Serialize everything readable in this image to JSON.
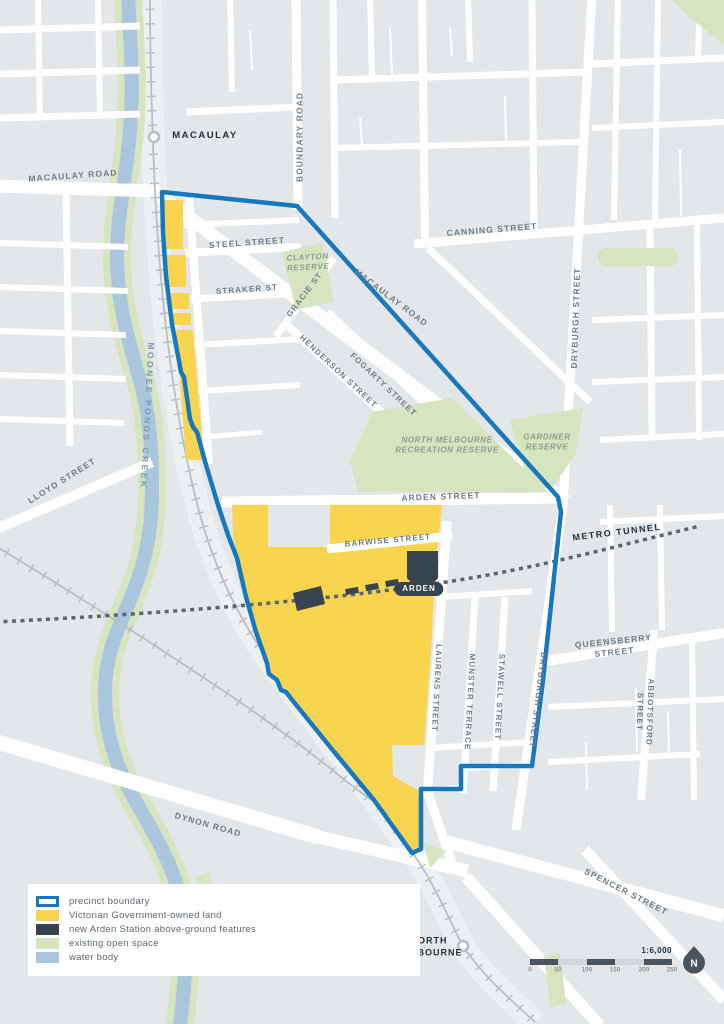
{
  "colors": {
    "precinct_boundary": "#1679BE",
    "government_land": "#F9D44F",
    "station_features": "#37434F",
    "open_space": "#D6E4C0",
    "water_body": "#A9C6DE"
  },
  "legend": {
    "items": [
      {
        "label": "precinct boundary",
        "swatch": "sw-boundary"
      },
      {
        "label": "Victorian Government-owned land",
        "swatch": "sw-yellow"
      },
      {
        "label": "new Arden Station above-ground features",
        "swatch": "sw-navy"
      },
      {
        "label": "existing open space",
        "swatch": "sw-green"
      },
      {
        "label": "water body",
        "swatch": "sw-water"
      }
    ]
  },
  "scale": {
    "ratio_label": "1:6,000",
    "north_label": "N",
    "ticks": [
      {
        "text": "0",
        "x": 0,
        "y": 24
      },
      {
        "text": "50",
        "x": 28,
        "y": 24
      },
      {
        "text": "100",
        "x": 57,
        "y": 24
      },
      {
        "text": "150",
        "x": 85,
        "y": 24
      },
      {
        "text": "200",
        "x": 114,
        "y": 24
      },
      {
        "text": "250",
        "x": 142,
        "y": 24
      }
    ]
  },
  "stations": {
    "arden": "ARDEN",
    "macaulay": "MACAULAY",
    "north_melbourne": "NORTH\nMELBOURNE"
  },
  "map_labels": [
    {
      "text": "MACAULAY ROAD",
      "x": 73,
      "y": 176,
      "rot": -4,
      "size": 8.5
    },
    {
      "text": "BOUNDARY ROAD",
      "x": 300,
      "y": 137,
      "rot": -90,
      "size": 8.5
    },
    {
      "text": "STEEL STREET",
      "x": 247,
      "y": 243,
      "rot": -4,
      "size": 8.5
    },
    {
      "text": "STRAKER ST",
      "x": 247,
      "y": 290,
      "rot": -4,
      "size": 8
    },
    {
      "text": "CLAYTON\nRESERVE",
      "x": 308,
      "y": 263,
      "rot": -3,
      "size": 8,
      "cls": "lbl-reserve"
    },
    {
      "text": "GRACIE ST",
      "x": 305,
      "y": 295,
      "rot": -53,
      "size": 8
    },
    {
      "text": "MACAULAY ROAD",
      "x": 391,
      "y": 298,
      "rot": 37,
      "size": 8.5
    },
    {
      "text": "CANNING STREET",
      "x": 492,
      "y": 230,
      "rot": -4.5,
      "size": 8.5
    },
    {
      "text": "DRYBURGH STREET",
      "x": 576,
      "y": 318,
      "rot": -88,
      "size": 8.5
    },
    {
      "text": "HENDERSON STREET",
      "x": 338,
      "y": 372,
      "rot": 43,
      "size": 8
    },
    {
      "text": "FOGARTY STREET",
      "x": 383,
      "y": 385,
      "rot": 43.5,
      "size": 8
    },
    {
      "text": "NORTH MELBOURNE\nRECREATION RESERVE",
      "x": 447,
      "y": 446,
      "rot": 0,
      "size": 8,
      "cls": "lbl-reserve"
    },
    {
      "text": "GARDINER\nRESERVE",
      "x": 547,
      "y": 443,
      "rot": 0,
      "size": 8,
      "cls": "lbl-reserve"
    },
    {
      "text": "ARDEN STREET",
      "x": 441,
      "y": 497,
      "rot": -2,
      "size": 8.5
    },
    {
      "text": "LLOYD STREET",
      "x": 62,
      "y": 481,
      "rot": -32,
      "size": 8.5
    },
    {
      "text": "MOONEE PONDS CREEK",
      "x": 147,
      "y": 416,
      "rot": 93,
      "size": 8.5,
      "cls": "lbl-creek",
      "ls": 2.5
    },
    {
      "text": "BARWISE STREET",
      "x": 388,
      "y": 541,
      "rot": -5,
      "size": 8
    },
    {
      "text": "METRO TUNNEL",
      "x": 617,
      "y": 533,
      "rot": -7,
      "size": 9,
      "cls": "lbl-tunnel",
      "ls": 1.5
    },
    {
      "text": "QUEENSBERRY STREET",
      "x": 614,
      "y": 647,
      "rot": -6,
      "size": 8.5
    },
    {
      "text": "LAURENS STREET",
      "x": 436,
      "y": 688,
      "rot": 93,
      "size": 8
    },
    {
      "text": "MUNSTER TERRACE",
      "x": 469,
      "y": 702,
      "rot": 93,
      "size": 8
    },
    {
      "text": "STAWELL STREET",
      "x": 499,
      "y": 697,
      "rot": 93,
      "size": 8
    },
    {
      "text": "DRYBURGH STREET",
      "x": 537,
      "y": 700,
      "rot": 97,
      "size": 8
    },
    {
      "text": "ABBOTSFORD STREET",
      "x": 644,
      "y": 712,
      "rot": 92,
      "size": 8
    },
    {
      "text": "SPENCER STREET",
      "x": 626,
      "y": 892,
      "rot": 27,
      "size": 8.5
    },
    {
      "text": "DYNON ROAD",
      "x": 208,
      "y": 825,
      "rot": 16,
      "size": 8.5
    },
    {
      "text": "MACAULAY",
      "x": 205,
      "y": 136,
      "rot": 0,
      "size": 9.5,
      "cls": "lbl-station",
      "ls": 1.5
    },
    {
      "text": "NORTH\nMELBOURNE",
      "x": 429,
      "y": 947,
      "rot": 0,
      "size": 9,
      "cls": "lbl-station",
      "ls": 1
    }
  ]
}
